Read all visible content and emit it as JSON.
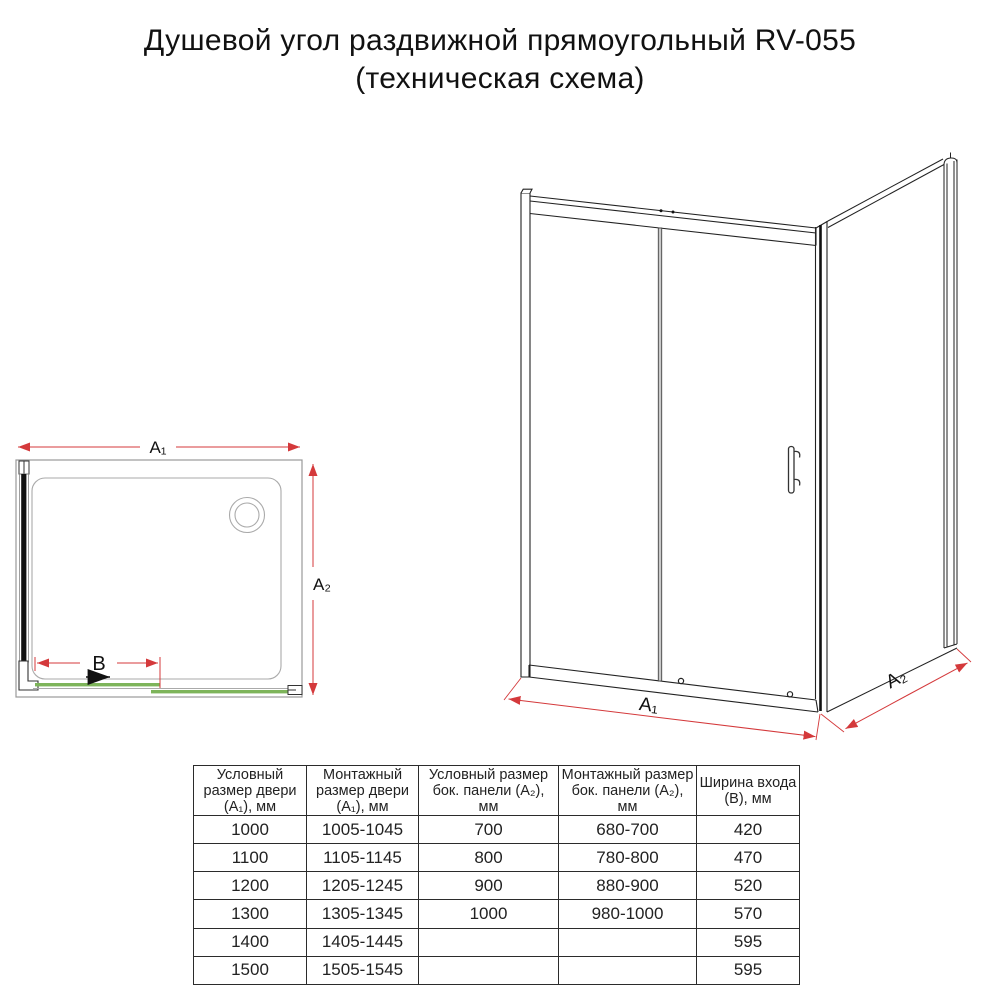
{
  "title": {
    "line1": "Душевой угол раздвижной прямоугольный RV-055",
    "line2": "(техническая схема)"
  },
  "colors": {
    "dimension_red": "#d4393b",
    "door_green": "#7db45a",
    "line_black": "#1a1a1a",
    "line_gray": "#999999"
  },
  "plan_view": {
    "dim_a1": "A₁",
    "dim_a2": "A₂",
    "dim_b": "B"
  },
  "iso_view": {
    "dim_a1": "A₁",
    "dim_a2": "A₂"
  },
  "table": {
    "headers": [
      "Условный размер двери (A₁), мм",
      "Монтажный размер двери (A₁), мм",
      "Условный размер бок. панели (A₂), мм",
      "Монтажный размер бок. панели (A₂), мм",
      "Ширина входа (B), мм"
    ],
    "rows": [
      [
        "1000",
        "1005-1045",
        "700",
        "680-700",
        "420"
      ],
      [
        "1100",
        "1105-1145",
        "800",
        "780-800",
        "470"
      ],
      [
        "1200",
        "1205-1245",
        "900",
        "880-900",
        "520"
      ],
      [
        "1300",
        "1305-1345",
        "1000",
        "980-1000",
        "570"
      ],
      [
        "1400",
        "1405-1445",
        "",
        "",
        "595"
      ],
      [
        "1500",
        "1505-1545",
        "",
        "",
        "595"
      ]
    ]
  }
}
